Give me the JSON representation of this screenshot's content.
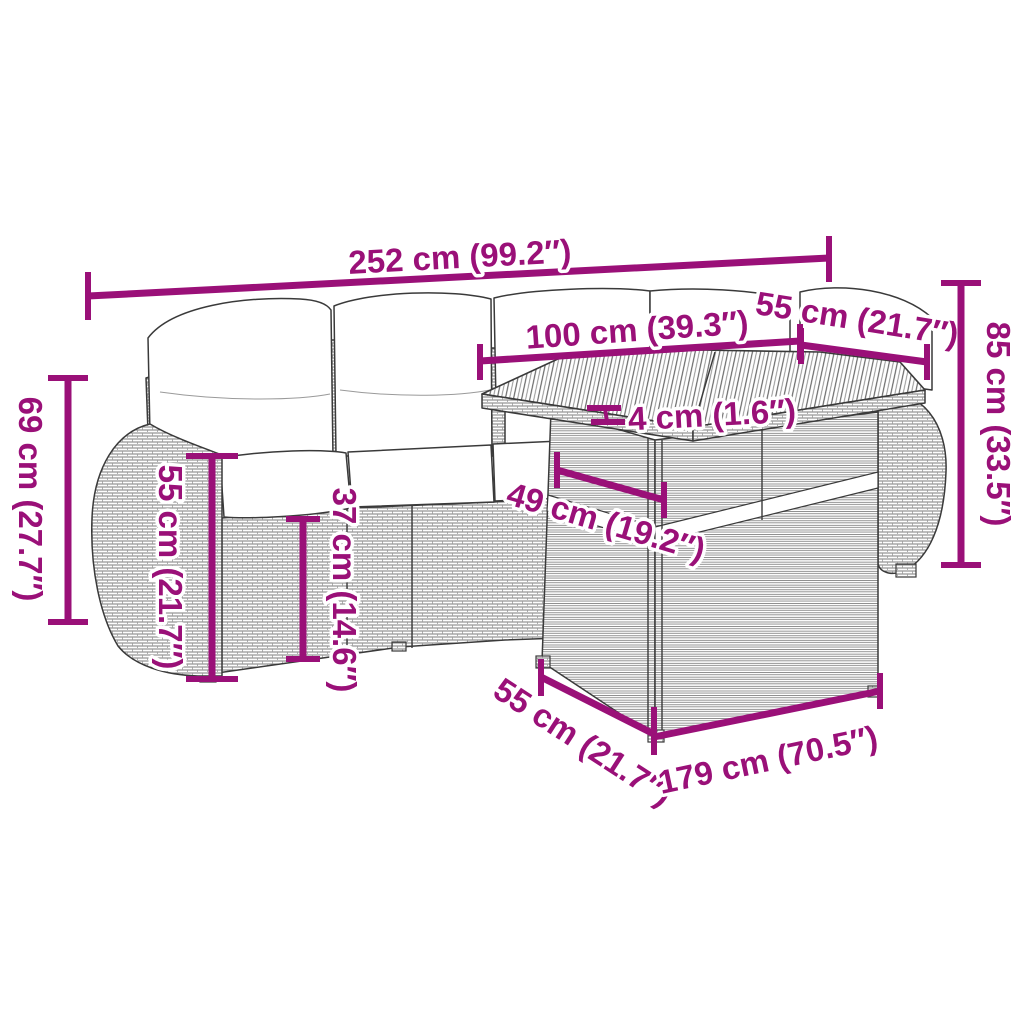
{
  "diagram": {
    "type": "product-dimension-diagram",
    "subject": "garden-lounge-set-with-table",
    "background": "#ffffff",
    "colors": {
      "dimension_accent": "#9a1078",
      "line_art": "#3a3a3a",
      "cushion_fill": "#ffffff"
    },
    "dimensions": {
      "overall_width": {
        "label": "252 cm (99.2″)",
        "cm": 252,
        "inches": 99.2
      },
      "table_top_width": {
        "label": "100 cm (39.3″)",
        "cm": 100,
        "inches": 39.3
      },
      "table_top_depth": {
        "label": "55 cm (21.7″)",
        "cm": 55,
        "inches": 21.7
      },
      "overall_height": {
        "label": "85 cm (33.5″)",
        "cm": 85,
        "inches": 33.5
      },
      "armrest_height": {
        "label": "69 cm (27.7″)",
        "cm": 69,
        "inches": 27.7
      },
      "backrest_height": {
        "label": "55 cm (21.7″)",
        "cm": 55,
        "inches": 21.7
      },
      "seat_height": {
        "label": "37 cm (14.6″)",
        "cm": 37,
        "inches": 14.6
      },
      "tabletop_thickness": {
        "label": "4 cm (1.6″)",
        "cm": 4,
        "inches": 1.6
      },
      "under_table_clearance": {
        "label": "49 cm (19.2″)",
        "cm": 49,
        "inches": 19.2
      },
      "seat_depth": {
        "label": "55 cm (21.7″)",
        "cm": 55,
        "inches": 21.7
      },
      "sofa_length": {
        "label": "179 cm (70.5″)",
        "cm": 179,
        "inches": 70.5
      }
    }
  }
}
